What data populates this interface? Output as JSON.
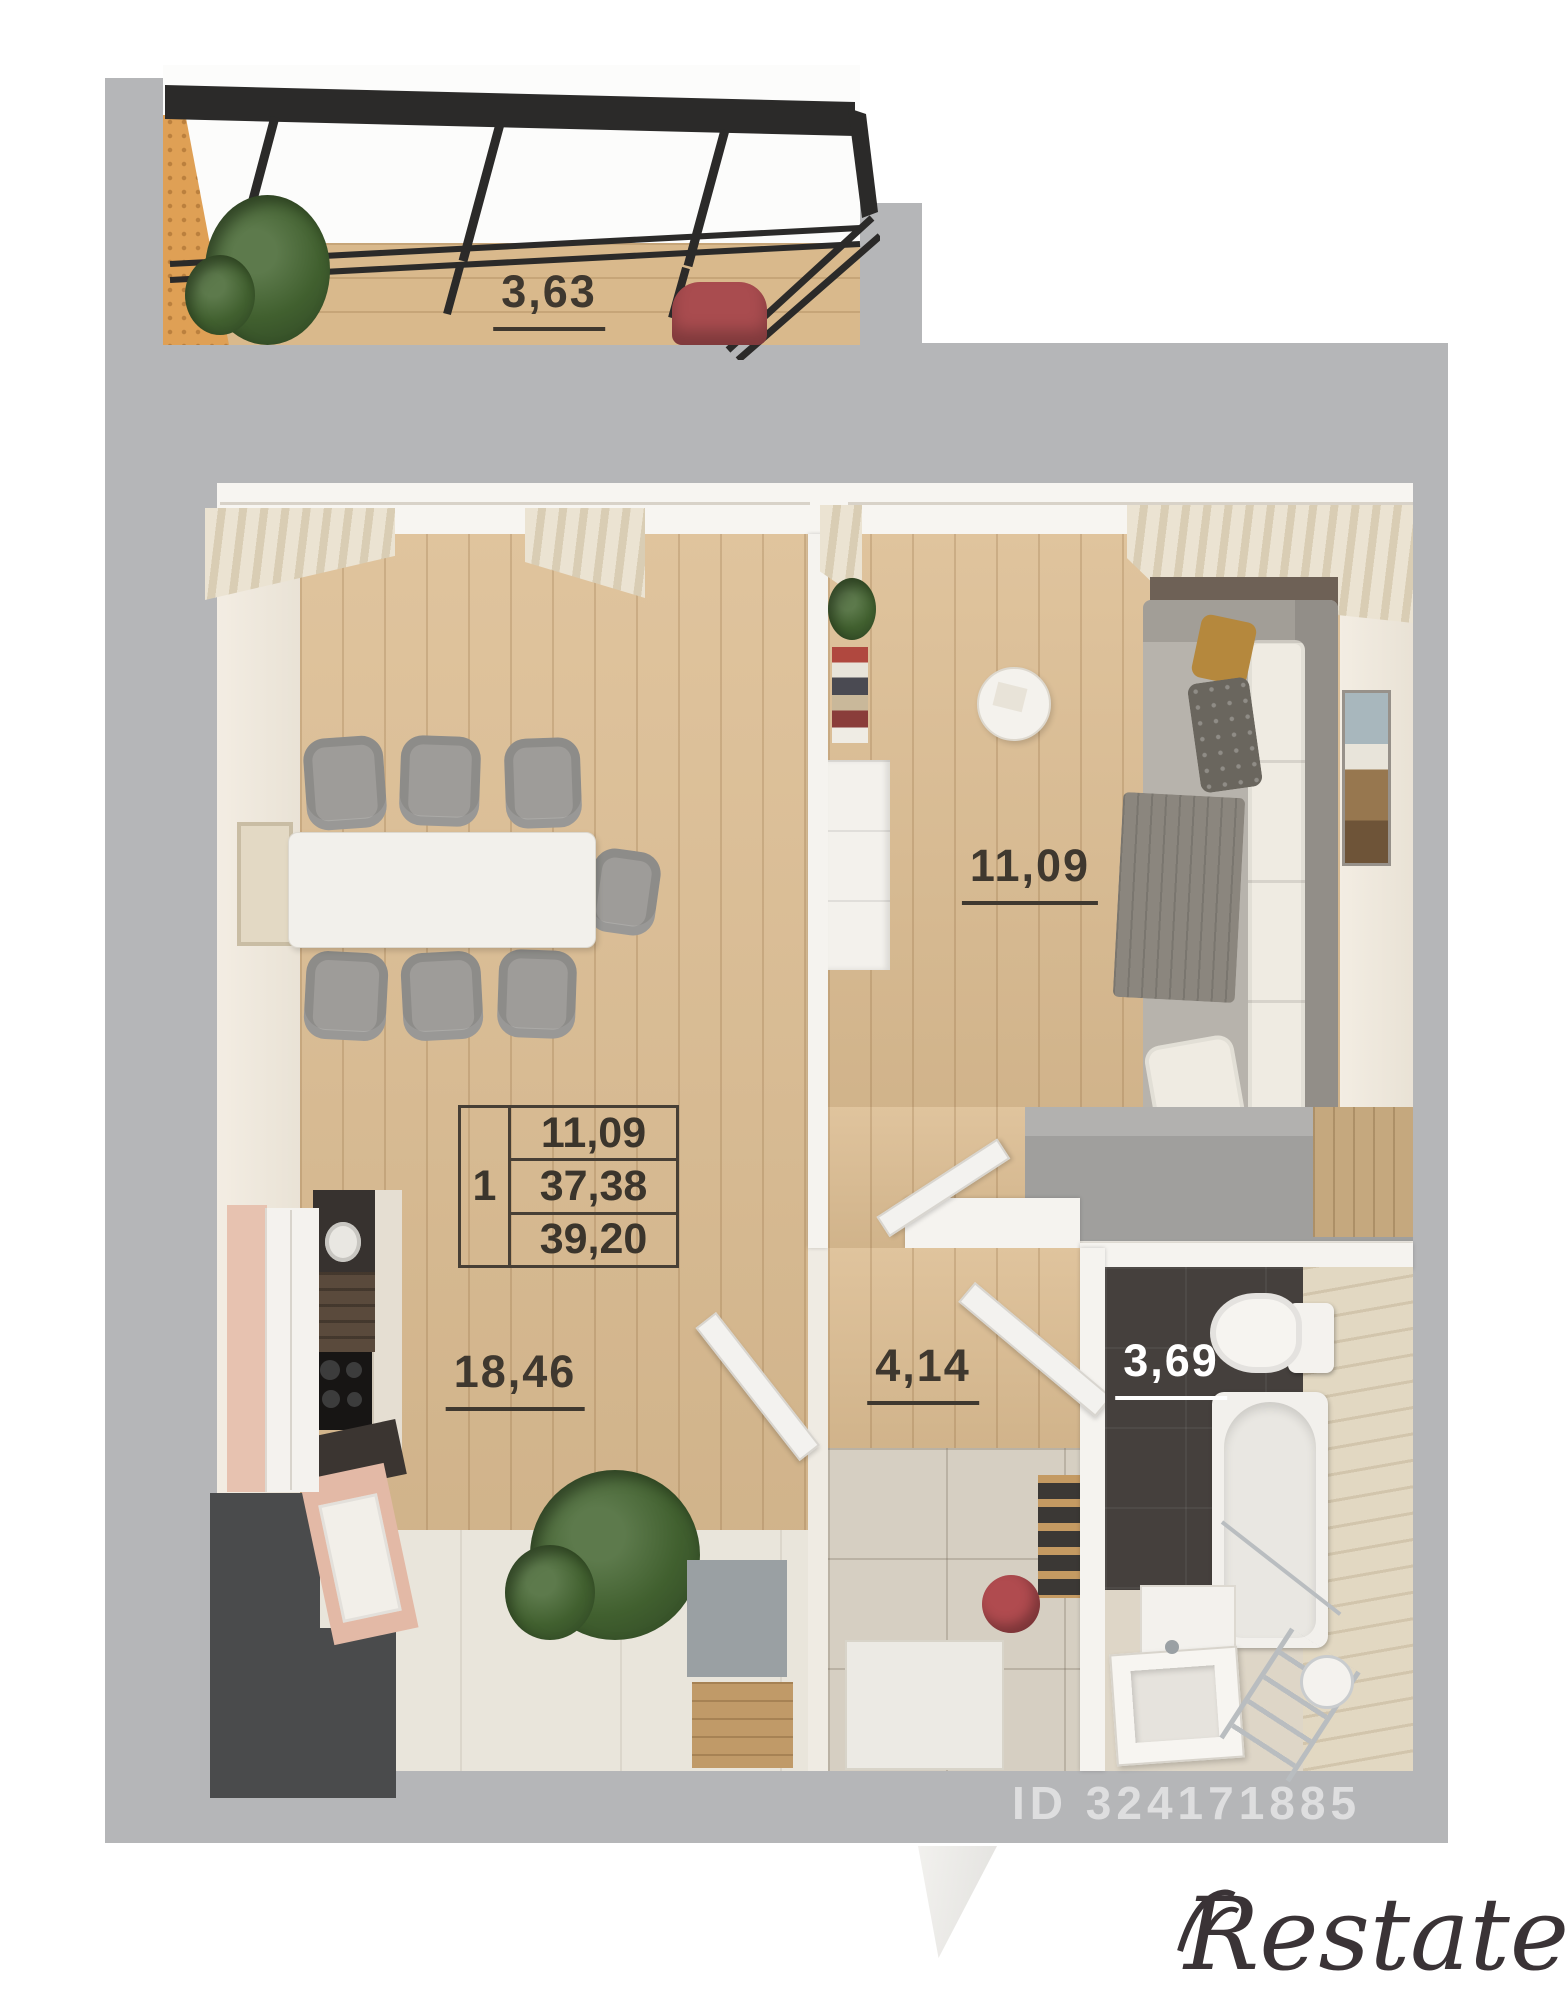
{
  "labels": {
    "balcony": "3,63",
    "kitchen": "18,46",
    "living": "11,09",
    "hall": "4,14",
    "bath": "3,69"
  },
  "summary": {
    "rooms": "1",
    "living_area": "11,09",
    "apartment_area": "37,38",
    "total_area": "39,20"
  },
  "watermark": {
    "text": "ID 324171885"
  },
  "brand": {
    "text": "Restate"
  },
  "colors": {
    "wall_gray": "#b5b6b8",
    "wood_floor": "#dcbd92",
    "dark_tile": "#45403d",
    "beige_tile": "#e2d8c2",
    "frame_black": "#2b2a29",
    "accent_red": "#a94c4f",
    "cabinet_pink": "#e5bfae",
    "label_dark": "#3f382f"
  }
}
